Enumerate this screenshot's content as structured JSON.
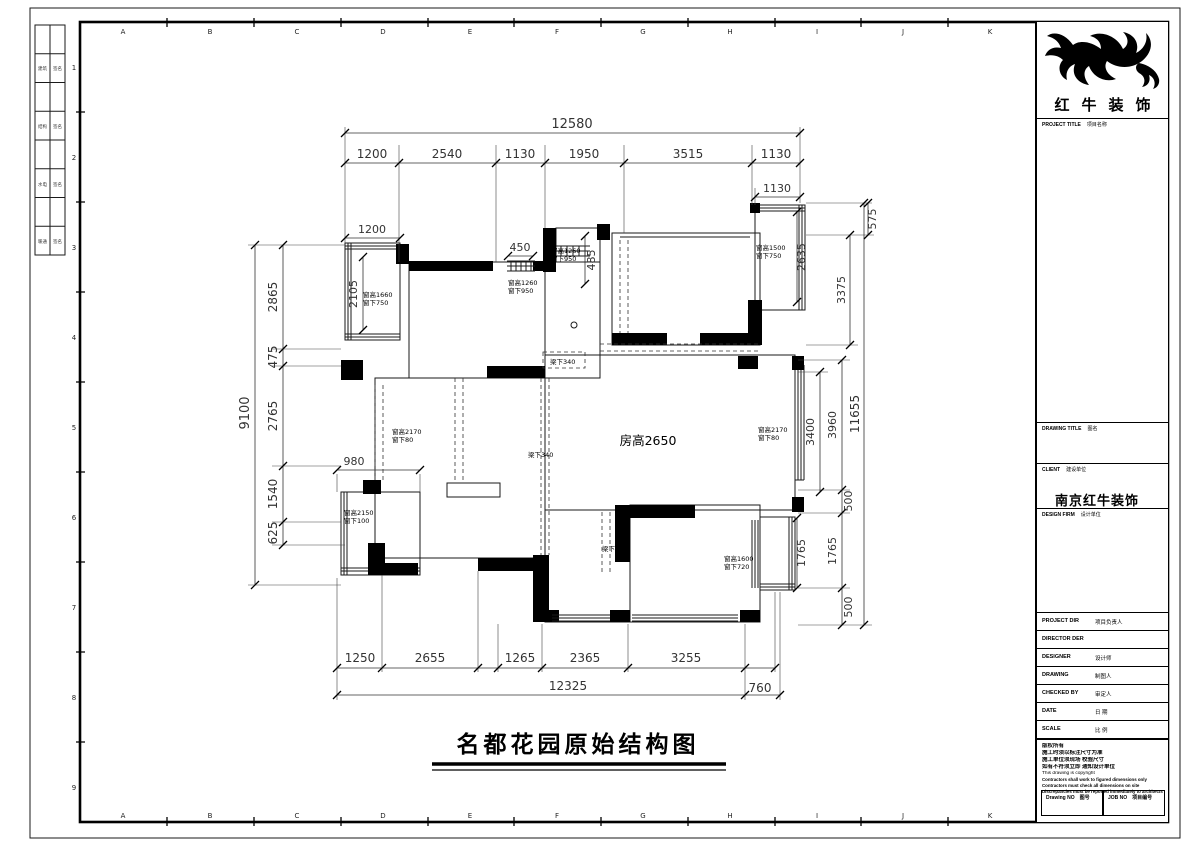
{
  "sheet": {
    "grid_letters": [
      "A",
      "B",
      "C",
      "D",
      "E",
      "F",
      "G",
      "H",
      "I",
      "J",
      "K"
    ],
    "grid_numbers": [
      "1",
      "2",
      "3",
      "4",
      "5",
      "6",
      "7",
      "8",
      "9"
    ],
    "side_table_rows": [
      {
        "c1": "建筑",
        "c2": "签名"
      },
      {
        "c1": "结构",
        "c2": "签名"
      },
      {
        "c1": "水电",
        "c2": "签名"
      },
      {
        "c1": "暖通",
        "c2": "签名"
      }
    ]
  },
  "drawing_title": "名都花园原始结构图",
  "plan_labels": {
    "room_height": "房高2650",
    "win_tl_1": "窗高1660",
    "win_tl_2": "窗下750",
    "win_450a_1": "窗高1260",
    "win_450a_2": "窗下950",
    "win_450b_1": "窗高1260",
    "win_450b_2": "窗下950",
    "win_tr_1": "窗高1500",
    "win_tr_2": "窗下750",
    "win_left_1": "窗高2170",
    "win_left_2": "窗下80",
    "win_right_1": "窗高2170",
    "win_right_2": "窗下80",
    "win_bl_1": "窗高2150",
    "win_bl_2": "窗下100",
    "win_br_1": "窗高1600",
    "win_br_2": "窗下720",
    "beam_a": "梁下80",
    "beam_b": "梁下340",
    "beam_c": "梁下340",
    "beam_d": "梁下300"
  },
  "dims": {
    "top_total": "12580",
    "top": [
      "1200",
      "2540",
      "1130",
      "1950",
      "3515",
      "1130"
    ],
    "top_sub": "1130",
    "local_1200": "1200",
    "local_450": "450",
    "local_485": "485",
    "local_2105": "2105",
    "local_980": "980",
    "left_total": "9100",
    "left": [
      "2865",
      "475",
      "2765",
      "1540",
      "625"
    ],
    "right": {
      "r2635": "2635",
      "r1765_inner": "1765",
      "r3400": "3400",
      "r575": "575",
      "r3375": "3375",
      "r3960": "3960",
      "r500a": "500",
      "r1765": "1765",
      "r500b": "500",
      "total": "11655"
    },
    "bottom": [
      "1250",
      "2655",
      "1265",
      "2365",
      "3255"
    ],
    "bottom_total": "12325",
    "bottom_760": "760"
  },
  "title_block": {
    "brand": "红牛装饰",
    "project_title_en": "PROJECT TITLE",
    "project_title_zh": "项目名称",
    "drawing_title_en": "DRAWING TITLE",
    "drawing_title_zh": "图名",
    "client_en": "CLIENT",
    "client_zh": "建设单位",
    "design_firm_en": "DESIGN FIRM",
    "design_firm_zh": "设计单位",
    "firm_name": "南京红牛装饰",
    "info_rows": [
      {
        "en": "PROJECT DIR",
        "zh": "项目负责人"
      },
      {
        "en": "DIRECTOR DER",
        "zh": ""
      },
      {
        "en": "DESIGNER",
        "zh": "设计师"
      },
      {
        "en": "DRAWING",
        "zh": "制图人"
      },
      {
        "en": "CHECKED BY",
        "zh": "审定人"
      },
      {
        "en": "DATE",
        "zh": "日 期"
      },
      {
        "en": "SCALE",
        "zh": "比 例"
      }
    ],
    "notes": [
      "版权所有",
      "施工时须以标注尺寸为准",
      "施工单位须现场 校验尺寸",
      "如有不符须立即 通知设计单位",
      "This drawing is copyright",
      "Contractors shall work to figured dimensions only",
      "Contractors must check all dimensions on site",
      "Discrepancies must be reported immediately to architects"
    ],
    "drawing_no_en": "Drawing NO",
    "drawing_no_zh": "图号",
    "job_no_en": "JOB NO",
    "job_no_zh": "项目编号"
  }
}
